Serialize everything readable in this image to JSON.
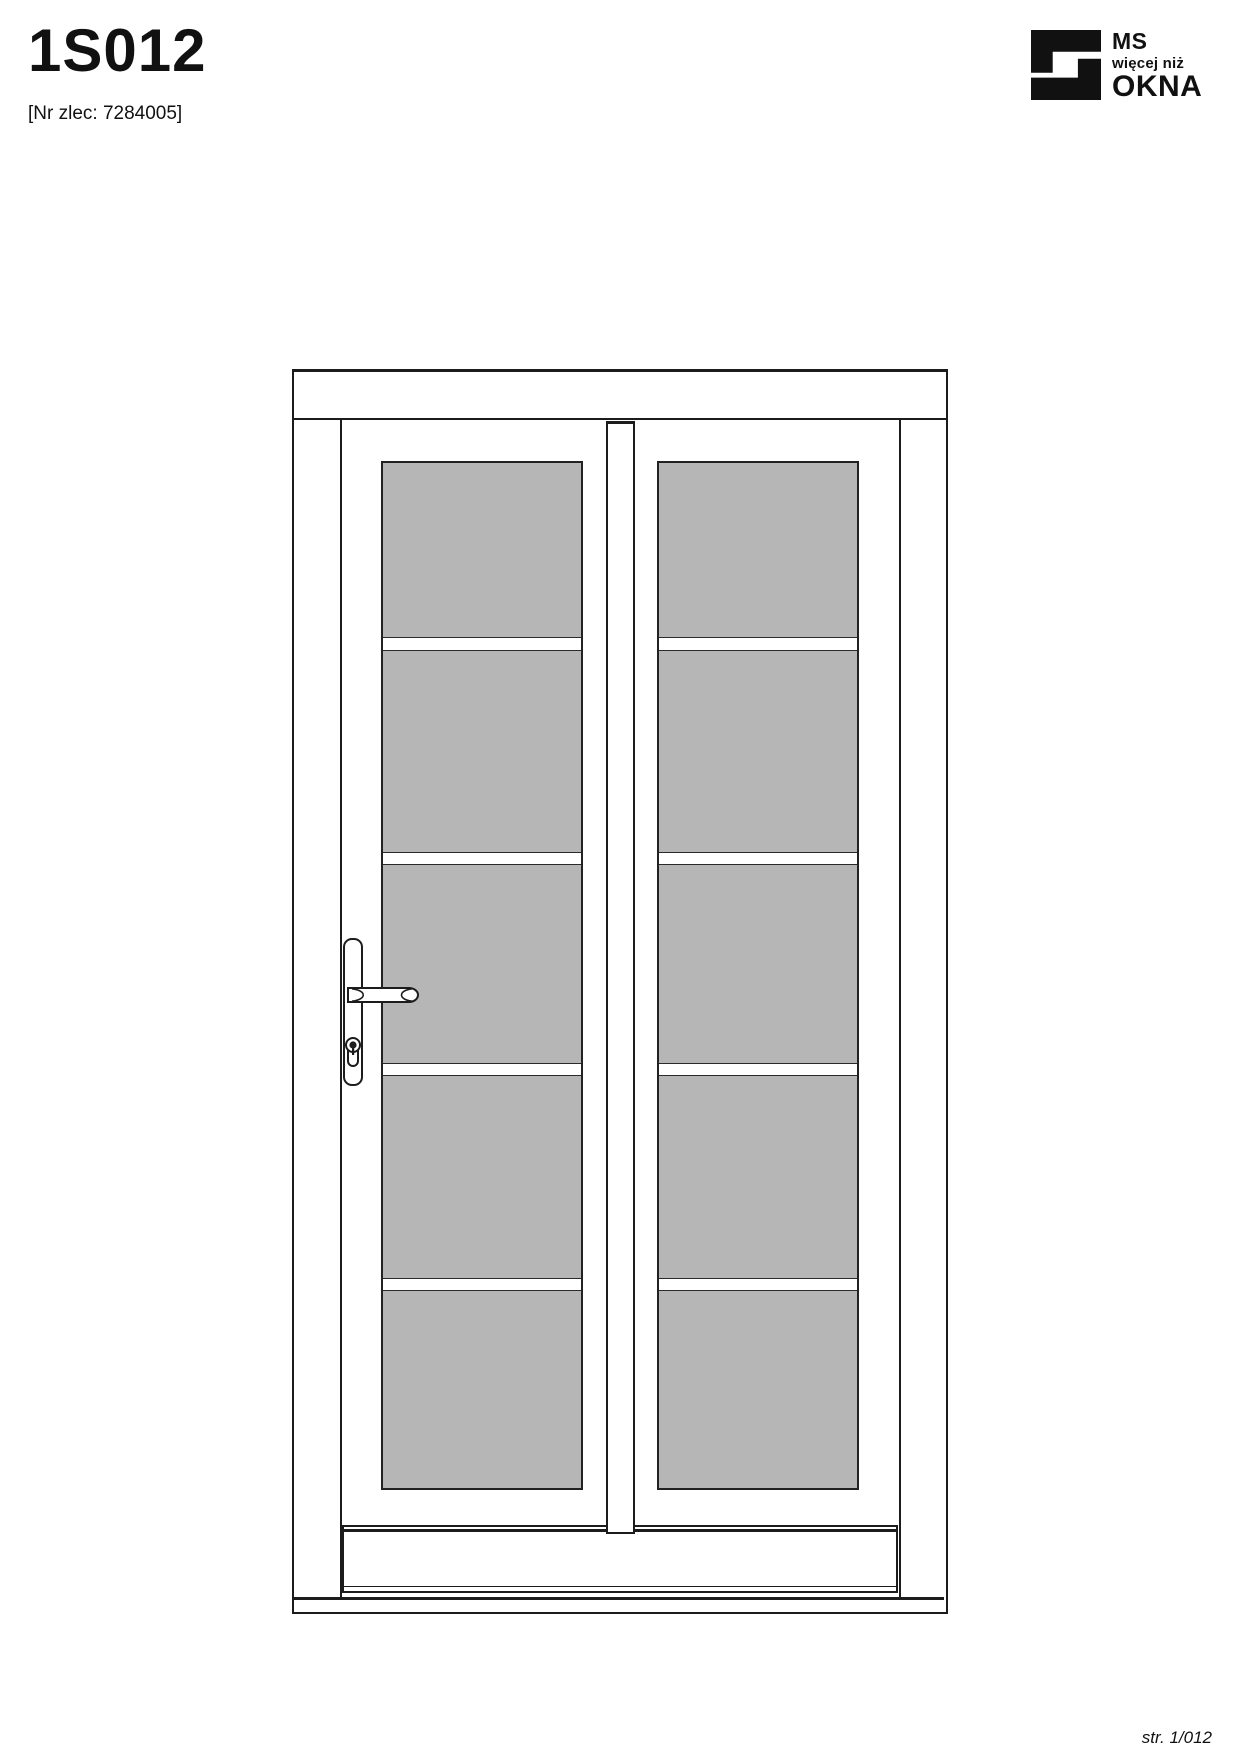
{
  "header": {
    "title": "1S012",
    "order_label": "[Nr zlec: 7284005]"
  },
  "logo": {
    "line1": "MS",
    "line2": "więcej niż",
    "line3": "OKNA"
  },
  "footer": {
    "page_label": "str. 1/012"
  },
  "drawing": {
    "subject": "double-leaf glazed entrance door, front view",
    "leaf_count": 2,
    "glass_rows_per_leaf": 5,
    "glass_color": "#b6b6b6",
    "line_color": "#1c1c1c",
    "hardware": "lever handle with lock cylinder on left leaf"
  }
}
